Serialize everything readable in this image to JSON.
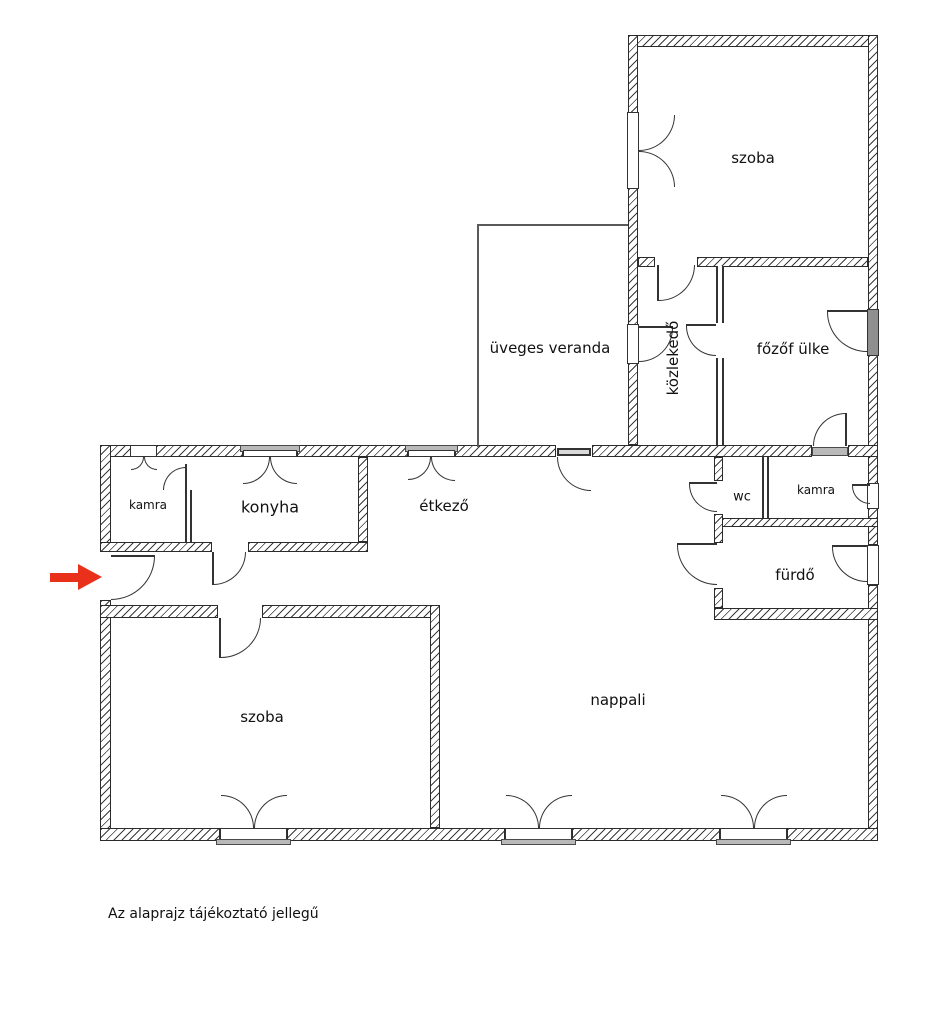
{
  "rooms": {
    "szoba_top": "szoba",
    "veranda": "üveges veranda",
    "kozlekedo": "közlekedő",
    "fozofulke": "főzőf ülke",
    "kamra_left": "kamra",
    "konyha": "konyha",
    "etkezo": "étkező",
    "wc": "wc",
    "kamra_right": "kamra",
    "furdo": "fürdő",
    "nappali": "nappali",
    "szoba_bottom": "szoba"
  },
  "caption": "Az alaprajz tájékoztató jellegű",
  "colors": {
    "arrow": "#e8301a",
    "wall_line": "#2b2b2b"
  }
}
